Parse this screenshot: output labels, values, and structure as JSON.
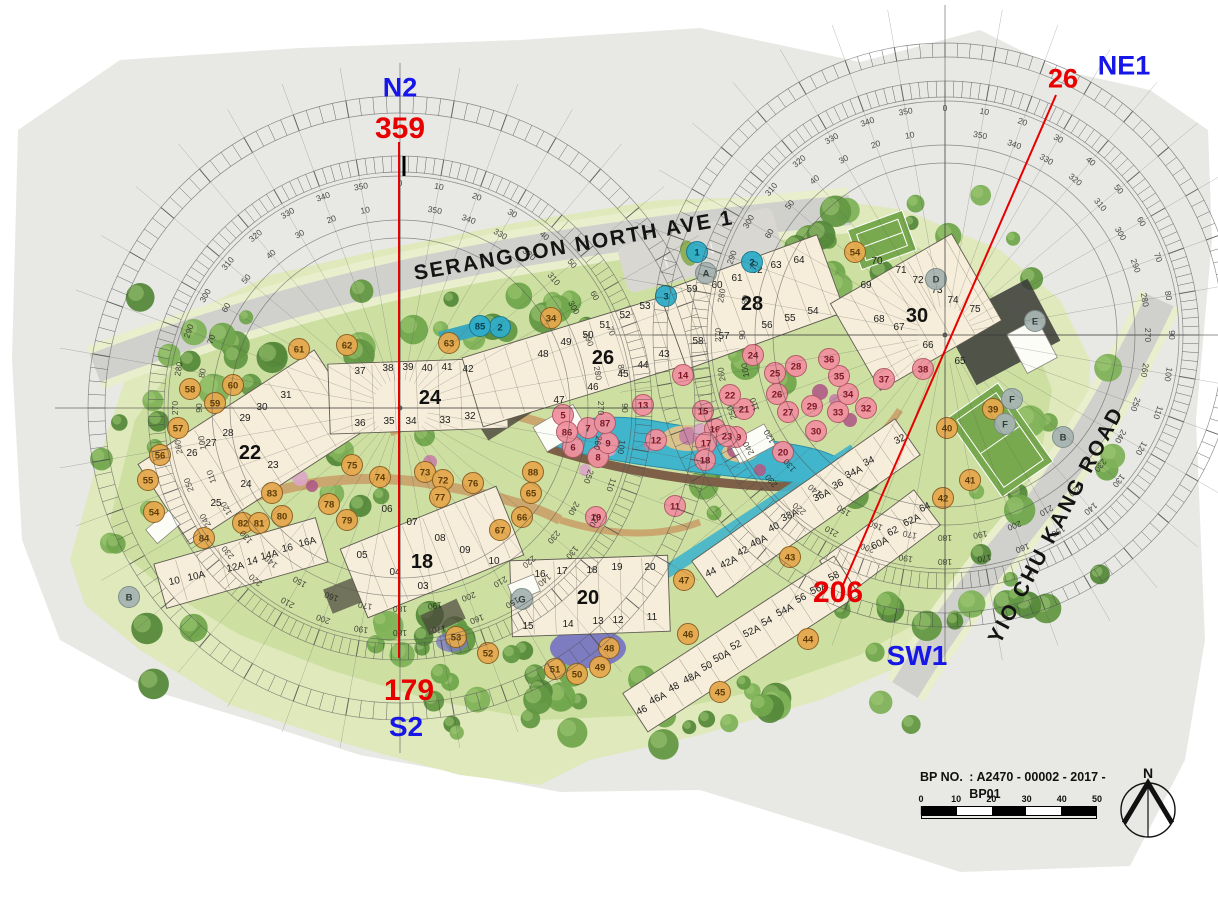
{
  "survey_points": [
    {
      "id": "N2",
      "bearing": "359"
    },
    {
      "id": "NE1",
      "bearing": "26"
    },
    {
      "id": "S2",
      "bearing": "179"
    },
    {
      "id": "SW1",
      "bearing": "206"
    }
  ],
  "roads": {
    "top": "SERANGOON NORTH AVE 1",
    "right": "YIO CHU KANG ROAD"
  },
  "title_block": {
    "bp_label": "BP NO.",
    "bp_value": ": A2470 - 00002 - 2017 - BP01",
    "date_label": "DATE",
    "date_value": ": 02 MAY 2018"
  },
  "scale_bar": {
    "ticks": [
      "0",
      "10",
      "20",
      "30",
      "40",
      "50"
    ]
  },
  "north": {
    "label": "N"
  },
  "palette": {
    "annotation_blue": "#1616e8",
    "annotation_red": "#e80000",
    "building_fill": "#f6eeda",
    "building_stroke": "#5f5b52",
    "water": "#41b5cc",
    "lawn_outer": "#dfe9bb",
    "lawn_inner": "#cde0a2",
    "road": "#d0d0cc",
    "page_gray": "#e8e8e5"
  },
  "compasses": [
    {
      "cx": 400,
      "cy": 408,
      "label_ring_r": 210,
      "tick_band_1": [
        236,
        252
      ],
      "tick_band_2": [
        295,
        312
      ],
      "extra_rings": [
        170
      ],
      "radial_r": 345,
      "step_deg": 10
    },
    {
      "cx": 945,
      "cy": 335,
      "label_ring_r": 212,
      "tick_band_1": [
        238,
        254
      ],
      "tick_band_2": [
        278,
        292
      ],
      "extra_rings": [
        172
      ],
      "radial_r": 330,
      "step_deg": 10
    }
  ],
  "survey_lines": [
    {
      "x1": 399,
      "y1": 142,
      "x2": 399,
      "y2": 658
    },
    {
      "x1": 1056,
      "y1": 95,
      "x2": 843,
      "y2": 585
    }
  ],
  "blocks": [
    {
      "n": "22",
      "lx": 250,
      "ly": 459,
      "urot": 0,
      "rects": [
        {
          "cx": 252,
          "cy": 447,
          "l": 210,
          "w": 95,
          "r": -33
        }
      ],
      "units": [
        [
          "26",
          192,
          456
        ],
        [
          "27",
          211,
          446
        ],
        [
          "28",
          228,
          436
        ],
        [
          "29",
          245,
          421
        ],
        [
          "30",
          262,
          410
        ],
        [
          "31",
          286,
          398
        ],
        [
          "23",
          273,
          468
        ],
        [
          "24",
          246,
          487
        ],
        [
          "25",
          216,
          506
        ]
      ]
    },
    {
      "n": "24",
      "lx": 430,
      "ly": 404,
      "urot": 0,
      "rects": [
        {
          "cx": 418,
          "cy": 396,
          "l": 178,
          "w": 70,
          "r": -2
        }
      ],
      "units": [
        [
          "37",
          360,
          374
        ],
        [
          "38",
          388,
          371
        ],
        [
          "39",
          408,
          370
        ],
        [
          "40",
          427,
          371
        ],
        [
          "41",
          447,
          370
        ],
        [
          "42",
          468,
          372
        ],
        [
          "36",
          360,
          426
        ],
        [
          "35",
          389,
          424
        ],
        [
          "34",
          411,
          424
        ],
        [
          "33",
          445,
          423
        ],
        [
          "32",
          470,
          419
        ]
      ]
    },
    {
      "n": "26",
      "lx": 603,
      "ly": 364,
      "urot": 0,
      "rects": [
        {
          "cx": 585,
          "cy": 358,
          "l": 235,
          "w": 72,
          "r": -17
        }
      ],
      "units": [
        [
          "43",
          664,
          357
        ],
        [
          "44",
          643,
          368
        ],
        [
          "45",
          623,
          377
        ],
        [
          "46",
          593,
          390
        ],
        [
          "47",
          559,
          403
        ],
        [
          "48",
          543,
          357
        ],
        [
          "49",
          566,
          345
        ],
        [
          "50",
          588,
          338
        ],
        [
          "51",
          605,
          328
        ],
        [
          "52",
          625,
          318
        ],
        [
          "53",
          645,
          309
        ]
      ]
    },
    {
      "n": "28",
      "lx": 752,
      "ly": 310,
      "urot": 0,
      "rects": [
        {
          "cx": 752,
          "cy": 302,
          "l": 168,
          "w": 82,
          "r": -20
        }
      ],
      "units": [
        [
          "59",
          692,
          292
        ],
        [
          "60",
          717,
          288
        ],
        [
          "61",
          737,
          281
        ],
        [
          "62",
          757,
          273
        ],
        [
          "63",
          776,
          268
        ],
        [
          "64",
          799,
          263
        ],
        [
          "58",
          698,
          344
        ],
        [
          "57",
          724,
          339
        ],
        [
          "56",
          767,
          328
        ],
        [
          "55",
          790,
          321
        ],
        [
          "54",
          813,
          314
        ]
      ]
    },
    {
      "n": "30",
      "lx": 917,
      "ly": 322,
      "urot": 0,
      "rects": [
        {
          "cx": 916,
          "cy": 312,
          "l": 140,
          "w": 100,
          "r": -30
        }
      ],
      "units": [
        [
          "69",
          866,
          288
        ],
        [
          "70",
          877,
          264
        ],
        [
          "71",
          901,
          273
        ],
        [
          "72",
          918,
          283
        ],
        [
          "73",
          937,
          293
        ],
        [
          "74",
          953,
          303
        ],
        [
          "75",
          975,
          312
        ],
        [
          "68",
          879,
          322
        ],
        [
          "67",
          899,
          330
        ],
        [
          "66",
          928,
          348
        ],
        [
          "65",
          960,
          364
        ]
      ]
    },
    {
      "n": "18",
      "lx": 422,
      "ly": 568,
      "urot": 0,
      "rects": [
        {
          "cx": 432,
          "cy": 552,
          "l": 168,
          "w": 74,
          "r": -22
        }
      ],
      "units": [
        [
          "06",
          387,
          512
        ],
        [
          "07",
          412,
          525
        ],
        [
          "08",
          440,
          541
        ],
        [
          "09",
          465,
          553
        ],
        [
          "10",
          494,
          564
        ],
        [
          "03",
          423,
          589
        ],
        [
          "04",
          395,
          575
        ],
        [
          "05",
          362,
          558
        ]
      ]
    },
    {
      "n": "20",
      "lx": 588,
      "ly": 604,
      "urot": 0,
      "rects": [
        {
          "cx": 590,
          "cy": 596,
          "l": 158,
          "w": 76,
          "r": -2
        }
      ],
      "units": [
        [
          "16",
          540,
          577
        ],
        [
          "17",
          562,
          574
        ],
        [
          "18",
          592,
          573
        ],
        [
          "19",
          617,
          570
        ],
        [
          "20",
          650,
          570
        ],
        [
          "15",
          528,
          629
        ],
        [
          "14",
          568,
          627
        ],
        [
          "13",
          598,
          624
        ],
        [
          "12",
          618,
          623
        ],
        [
          "11",
          652,
          620
        ]
      ]
    },
    {
      "n": "",
      "lx": 0,
      "ly": 0,
      "urot": -12,
      "rects": [
        {
          "cx": 241,
          "cy": 563,
          "l": 168,
          "w": 46,
          "r": -16
        }
      ],
      "units": [
        [
          "10",
          175,
          584
        ],
        [
          "10A",
          197,
          579
        ],
        [
          "12A",
          236,
          570
        ],
        [
          "14",
          253,
          564
        ],
        [
          "14A",
          270,
          558
        ],
        [
          "16",
          288,
          551
        ],
        [
          "16A",
          308,
          545
        ]
      ]
    },
    {
      "n": "",
      "lx": 0,
      "ly": 0,
      "urot": -25,
      "rects": [
        {
          "cx": 806,
          "cy": 508,
          "l": 248,
          "w": 44,
          "r": -35
        }
      ],
      "units": [
        [
          "32",
          901,
          442
        ],
        [
          "34",
          870,
          464
        ],
        [
          "34A",
          855,
          475
        ],
        [
          "36",
          839,
          487
        ],
        [
          "36A",
          823,
          498
        ],
        [
          "38A",
          791,
          518
        ],
        [
          "40",
          775,
          530
        ],
        [
          "40A",
          760,
          544
        ],
        [
          "42",
          744,
          554
        ],
        [
          "42A",
          730,
          565
        ],
        [
          "44",
          712,
          575
        ]
      ]
    },
    {
      "n": "",
      "lx": 0,
      "ly": 0,
      "urot": -25,
      "rects": [
        {
          "cx": 880,
          "cy": 543,
          "l": 118,
          "w": 44,
          "r": -37
        }
      ],
      "units": [
        [
          "64",
          926,
          510
        ],
        [
          "62A",
          913,
          523
        ],
        [
          "62",
          894,
          534
        ],
        [
          "60A",
          881,
          546
        ]
      ]
    },
    {
      "n": "",
      "lx": 0,
      "ly": 0,
      "urot": -25,
      "rects": [
        {
          "cx": 741,
          "cy": 644,
          "l": 252,
          "w": 46,
          "r": -33
        }
      ],
      "units": [
        [
          "58",
          835,
          579
        ],
        [
          "56A",
          820,
          591
        ],
        [
          "56",
          802,
          601
        ],
        [
          "54A",
          786,
          613
        ],
        [
          "54",
          768,
          624
        ],
        [
          "52A",
          753,
          634
        ],
        [
          "52",
          737,
          648
        ],
        [
          "50A",
          723,
          659
        ],
        [
          "50",
          708,
          669
        ],
        [
          "48A",
          693,
          680
        ],
        [
          "48",
          675,
          690
        ],
        [
          "46A",
          659,
          701
        ],
        [
          "46",
          643,
          713
        ]
      ]
    }
  ],
  "marker_colors": {
    "o": {
      "fill": "#e6a94e",
      "stroke": "#8a5d1f",
      "text": "#5d3c08"
    },
    "p": {
      "fill": "#f0929f",
      "stroke": "#b05565",
      "text": "#7c1626"
    },
    "b": {
      "fill": "#2fadc8",
      "stroke": "#17768e",
      "text": "#083d4d"
    },
    "g": {
      "fill": "#a7b4b1",
      "stroke": "#7a8c89",
      "text": "#2f3d3b"
    }
  },
  "markers": [
    {
      "t": "54",
      "c": "o",
      "x": 154,
      "y": 512
    },
    {
      "t": "84",
      "c": "o",
      "x": 204,
      "y": 538
    },
    {
      "t": "82",
      "c": "o",
      "x": 243,
      "y": 523
    },
    {
      "t": "81",
      "c": "o",
      "x": 259,
      "y": 523
    },
    {
      "t": "80",
      "c": "o",
      "x": 282,
      "y": 516
    },
    {
      "t": "83",
      "c": "o",
      "x": 272,
      "y": 493
    },
    {
      "t": "78",
      "c": "o",
      "x": 329,
      "y": 504
    },
    {
      "t": "79",
      "c": "o",
      "x": 347,
      "y": 520
    },
    {
      "t": "75",
      "c": "o",
      "x": 352,
      "y": 465
    },
    {
      "t": "74",
      "c": "o",
      "x": 380,
      "y": 477
    },
    {
      "t": "73",
      "c": "o",
      "x": 425,
      "y": 472
    },
    {
      "t": "72",
      "c": "o",
      "x": 443,
      "y": 480
    },
    {
      "t": "76",
      "c": "o",
      "x": 473,
      "y": 483
    },
    {
      "t": "77",
      "c": "o",
      "x": 440,
      "y": 497
    },
    {
      "t": "88",
      "c": "o",
      "x": 533,
      "y": 472
    },
    {
      "t": "65",
      "c": "o",
      "x": 531,
      "y": 493
    },
    {
      "t": "66",
      "c": "o",
      "x": 522,
      "y": 517
    },
    {
      "t": "67",
      "c": "o",
      "x": 500,
      "y": 530
    },
    {
      "t": "58",
      "c": "o",
      "x": 190,
      "y": 389
    },
    {
      "t": "59",
      "c": "o",
      "x": 215,
      "y": 403
    },
    {
      "t": "60",
      "c": "o",
      "x": 233,
      "y": 385
    },
    {
      "t": "57",
      "c": "o",
      "x": 178,
      "y": 428
    },
    {
      "t": "56",
      "c": "o",
      "x": 160,
      "y": 455
    },
    {
      "t": "55",
      "c": "o",
      "x": 148,
      "y": 480
    },
    {
      "t": "61",
      "c": "o",
      "x": 299,
      "y": 349
    },
    {
      "t": "62",
      "c": "o",
      "x": 347,
      "y": 345
    },
    {
      "t": "63",
      "c": "o",
      "x": 449,
      "y": 343
    },
    {
      "t": "34",
      "c": "o",
      "x": 551,
      "y": 318
    },
    {
      "t": "54",
      "c": "o",
      "x": 855,
      "y": 252
    },
    {
      "t": "39",
      "c": "o",
      "x": 993,
      "y": 409
    },
    {
      "t": "40",
      "c": "o",
      "x": 947,
      "y": 428
    },
    {
      "t": "41",
      "c": "o",
      "x": 970,
      "y": 480
    },
    {
      "t": "42",
      "c": "o",
      "x": 943,
      "y": 498
    },
    {
      "t": "43",
      "c": "o",
      "x": 790,
      "y": 557
    },
    {
      "t": "44",
      "c": "o",
      "x": 808,
      "y": 639
    },
    {
      "t": "45",
      "c": "o",
      "x": 720,
      "y": 692
    },
    {
      "t": "46",
      "c": "o",
      "x": 688,
      "y": 634
    },
    {
      "t": "47",
      "c": "o",
      "x": 684,
      "y": 580
    },
    {
      "t": "48",
      "c": "o",
      "x": 609,
      "y": 648
    },
    {
      "t": "49",
      "c": "o",
      "x": 600,
      "y": 667
    },
    {
      "t": "50",
      "c": "o",
      "x": 577,
      "y": 674
    },
    {
      "t": "51",
      "c": "o",
      "x": 555,
      "y": 669
    },
    {
      "t": "52",
      "c": "o",
      "x": 488,
      "y": 653
    },
    {
      "t": "53",
      "c": "o",
      "x": 456,
      "y": 637
    },
    {
      "t": "5",
      "c": "p",
      "x": 563,
      "y": 415
    },
    {
      "t": "6",
      "c": "p",
      "x": 573,
      "y": 447
    },
    {
      "t": "7",
      "c": "p",
      "x": 588,
      "y": 428
    },
    {
      "t": "8",
      "c": "p",
      "x": 598,
      "y": 457
    },
    {
      "t": "9",
      "c": "p",
      "x": 608,
      "y": 443
    },
    {
      "t": "86",
      "c": "p",
      "x": 567,
      "y": 432
    },
    {
      "t": "87",
      "c": "p",
      "x": 605,
      "y": 423
    },
    {
      "t": "10",
      "c": "p",
      "x": 596,
      "y": 517
    },
    {
      "t": "11",
      "c": "p",
      "x": 675,
      "y": 506
    },
    {
      "t": "12",
      "c": "p",
      "x": 656,
      "y": 440
    },
    {
      "t": "13",
      "c": "p",
      "x": 643,
      "y": 405
    },
    {
      "t": "14",
      "c": "p",
      "x": 683,
      "y": 375
    },
    {
      "t": "15",
      "c": "p",
      "x": 703,
      "y": 411
    },
    {
      "t": "16",
      "c": "p",
      "x": 715,
      "y": 429
    },
    {
      "t": "17",
      "c": "p",
      "x": 706,
      "y": 443
    },
    {
      "t": "18",
      "c": "p",
      "x": 705,
      "y": 460
    },
    {
      "t": "19",
      "c": "p",
      "x": 736,
      "y": 437
    },
    {
      "t": "20",
      "c": "p",
      "x": 783,
      "y": 452
    },
    {
      "t": "21",
      "c": "p",
      "x": 744,
      "y": 409
    },
    {
      "t": "22",
      "c": "p",
      "x": 730,
      "y": 395
    },
    {
      "t": "23",
      "c": "p",
      "x": 727,
      "y": 436
    },
    {
      "t": "24",
      "c": "p",
      "x": 753,
      "y": 355
    },
    {
      "t": "25",
      "c": "p",
      "x": 775,
      "y": 373
    },
    {
      "t": "26",
      "c": "p",
      "x": 777,
      "y": 394
    },
    {
      "t": "27",
      "c": "p",
      "x": 788,
      "y": 412
    },
    {
      "t": "28",
      "c": "p",
      "x": 796,
      "y": 366
    },
    {
      "t": "29",
      "c": "p",
      "x": 812,
      "y": 406
    },
    {
      "t": "30",
      "c": "p",
      "x": 816,
      "y": 431
    },
    {
      "t": "32",
      "c": "p",
      "x": 866,
      "y": 408
    },
    {
      "t": "33",
      "c": "p",
      "x": 838,
      "y": 412
    },
    {
      "t": "34",
      "c": "p",
      "x": 848,
      "y": 394
    },
    {
      "t": "35",
      "c": "p",
      "x": 839,
      "y": 376
    },
    {
      "t": "36",
      "c": "p",
      "x": 829,
      "y": 359
    },
    {
      "t": "37",
      "c": "p",
      "x": 884,
      "y": 379
    },
    {
      "t": "38",
      "c": "p",
      "x": 923,
      "y": 369
    },
    {
      "t": "1",
      "c": "b",
      "x": 697,
      "y": 252
    },
    {
      "t": "2",
      "c": "b",
      "x": 500,
      "y": 327
    },
    {
      "t": "85",
      "c": "b",
      "x": 480,
      "y": 326
    },
    {
      "t": "3",
      "c": "b",
      "x": 666,
      "y": 296
    },
    {
      "t": "2",
      "c": "b",
      "x": 752,
      "y": 262
    },
    {
      "t": "A",
      "c": "g",
      "x": 706,
      "y": 273
    },
    {
      "t": "B",
      "c": "g",
      "x": 129,
      "y": 597
    },
    {
      "t": "B",
      "c": "g",
      "x": 1063,
      "y": 437
    },
    {
      "t": "D",
      "c": "g",
      "x": 936,
      "y": 279
    },
    {
      "t": "E",
      "c": "g",
      "x": 1035,
      "y": 321
    },
    {
      "t": "F",
      "c": "g",
      "x": 1005,
      "y": 424
    },
    {
      "t": "F",
      "c": "g",
      "x": 1012,
      "y": 399
    },
    {
      "t": "G",
      "c": "g",
      "x": 522,
      "y": 599
    }
  ]
}
